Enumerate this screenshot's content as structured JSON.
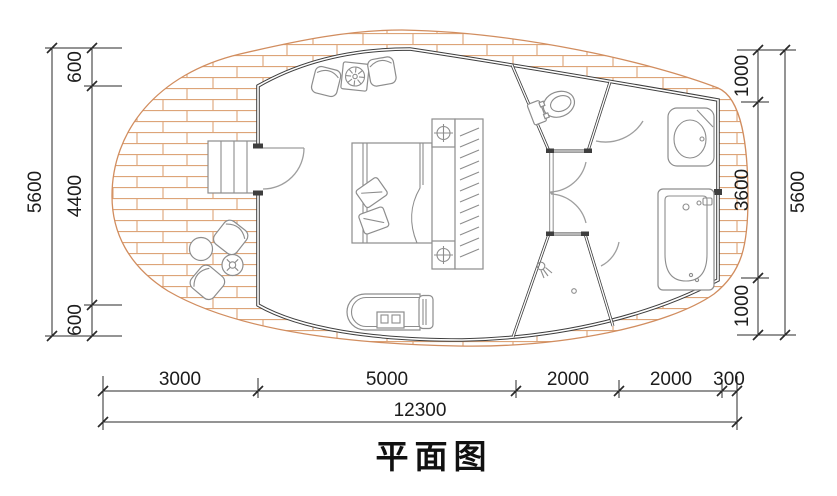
{
  "title": "平面图",
  "colors": {
    "brick": "#dda478",
    "brick_edge": "#d18d5f",
    "wall": "#3e3e3e",
    "furniture": "#8d8d8d",
    "door": "#9e9e9e",
    "dim": "#2a2a2a",
    "text": "#1c1c1c"
  },
  "dimensions": {
    "left": {
      "segments": [
        "600",
        "4400",
        "600"
      ],
      "total": "5600"
    },
    "right": {
      "segments": [
        "1000",
        "3600",
        "1000"
      ],
      "total": "5600"
    },
    "bottom": {
      "segments": [
        "3000",
        "5000",
        "2000",
        "2000",
        "300"
      ],
      "total": "12300"
    }
  },
  "icons": [
    "double-bed",
    "pillow",
    "nightstand",
    "table-lamp",
    "wardrobe-hanging-clothes",
    "armchair",
    "side-table",
    "toilet",
    "washbasin",
    "bathtub",
    "shower-head",
    "floor-drain",
    "chaise-lounge",
    "outdoor-chair",
    "outdoor-round-table",
    "plant-stand",
    "stairs",
    "door-swing",
    "brick-paved-deck"
  ]
}
